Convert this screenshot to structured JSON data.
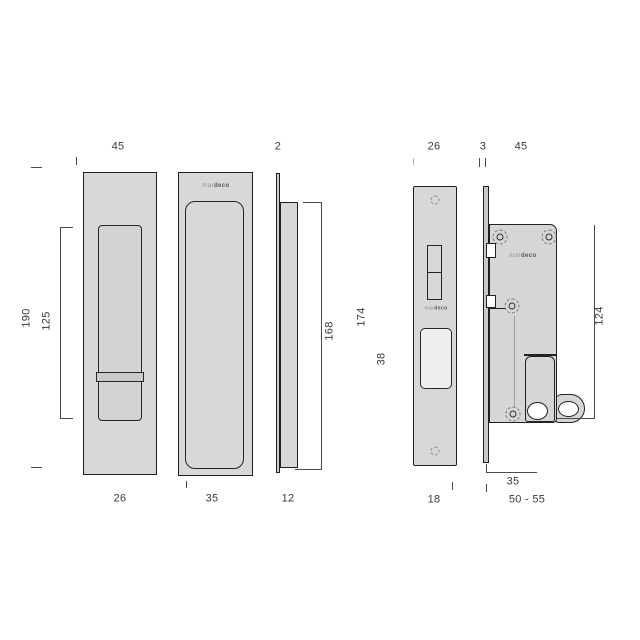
{
  "title": "Sliding door flush pull and mortice lock technical drawing",
  "brand": {
    "prefix": "mar",
    "suffix": "deco"
  },
  "views": {
    "pull_exterior": {
      "dim_width_top": "45",
      "dim_overall_height": "190",
      "dim_recess_height": "125",
      "dim_recess_width": "26"
    },
    "pull_interior": {
      "dim_recess_width": "35"
    },
    "pull_profile": {
      "dim_plate_thickness": "2",
      "dim_body_height": "168",
      "dim_overall_height": "174",
      "dim_depth": "38",
      "dim_body_thickness": "12"
    },
    "lock_faceplate": {
      "dim_width": "26",
      "dim_opening_width": "18"
    },
    "lock_case": {
      "dim_plate_thickness": "3",
      "dim_case_width": "45",
      "dim_case_height": "124",
      "dim_backset": "35",
      "dim_door_thickness": "50 - 55"
    }
  }
}
